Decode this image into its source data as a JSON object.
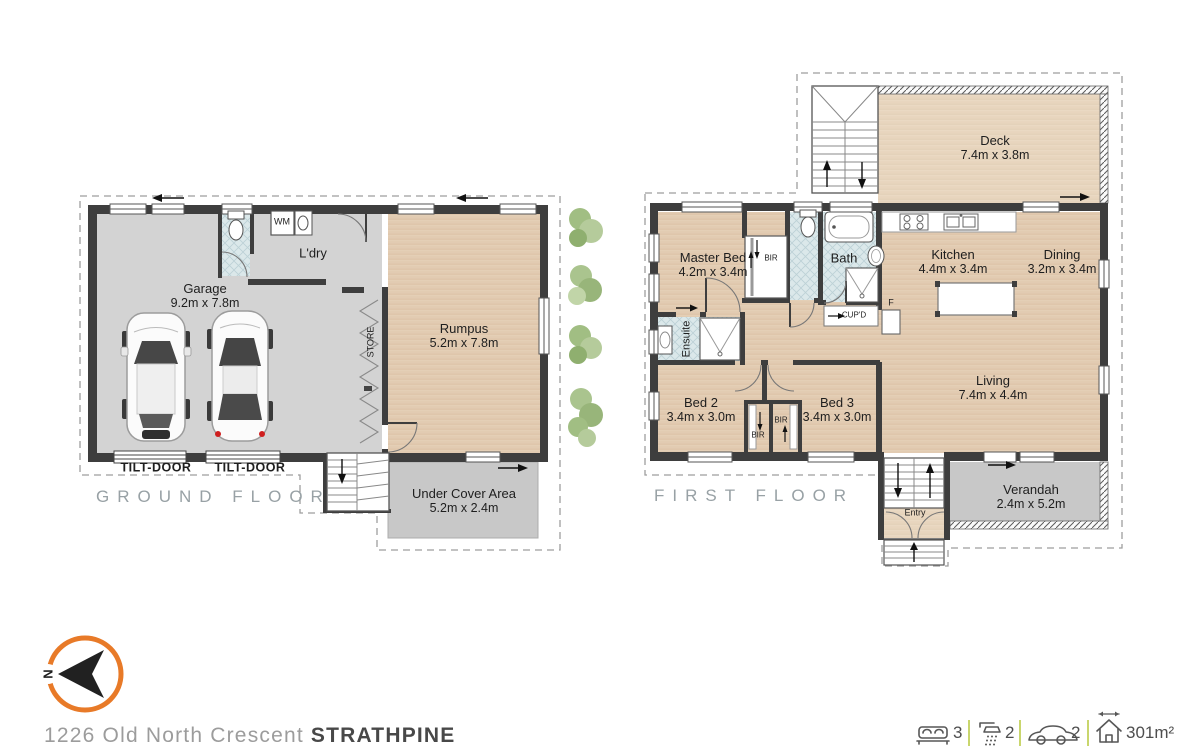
{
  "address": {
    "street": "1226 Old North Crescent",
    "suburb": "STRATHPINE"
  },
  "ground_floor": {
    "label": "GROUND FLOOR",
    "garage": {
      "name": "Garage",
      "dims": "9.2m x 7.8m"
    },
    "ldry": {
      "name": "L'dry"
    },
    "wm": {
      "name": "WM"
    },
    "store": {
      "name": "STORE"
    },
    "rumpus": {
      "name": "Rumpus",
      "dims": "5.2m x 7.8m"
    },
    "under_cover": {
      "name": "Under Cover Area",
      "dims": "5.2m x 2.4m"
    },
    "tilt_door_left": {
      "name": "TILT-DOOR"
    },
    "tilt_door_right": {
      "name": "TILT-DOOR"
    }
  },
  "first_floor": {
    "label": "FIRST FLOOR",
    "deck": {
      "name": "Deck",
      "dims": "7.4m x 3.8m"
    },
    "master_bed": {
      "name": "Master Bed",
      "dims": "4.2m x 3.4m"
    },
    "bir_master": {
      "name": "BIR"
    },
    "bath": {
      "name": "Bath"
    },
    "cupd": {
      "name": "CUP'D"
    },
    "fridge": {
      "name": "F"
    },
    "kitchen": {
      "name": "Kitchen",
      "dims": "4.4m x 3.4m"
    },
    "dining": {
      "name": "Dining",
      "dims": "3.2m x 3.4m"
    },
    "ensuite": {
      "name": "Ensuite"
    },
    "bed2": {
      "name": "Bed 2",
      "dims": "3.4m x 3.0m"
    },
    "bed3": {
      "name": "Bed 3",
      "dims": "3.4m x 3.0m"
    },
    "bir_bed2": {
      "name": "BIR"
    },
    "bir_bed3": {
      "name": "BIR"
    },
    "living": {
      "name": "Living",
      "dims": "7.4m x 4.4m"
    },
    "verandah": {
      "name": "Verandah",
      "dims": "2.4m x 5.2m"
    },
    "entry": {
      "name": "Entry"
    }
  },
  "compass": {
    "north_label": "N"
  },
  "stats": {
    "bedrooms": {
      "icon": "bed-icon",
      "value": "3"
    },
    "bathrooms": {
      "icon": "shower-icon",
      "value": "2"
    },
    "cars": {
      "icon": "car-icon",
      "value": "2"
    },
    "area": {
      "icon": "area-icon",
      "value": "301m²"
    }
  },
  "colors": {
    "wall": "#3e3e3e",
    "indoor_gray": "#d3d3d3",
    "outdoor_gray": "#c8c8c8",
    "wood": "#e4cfb6",
    "deck_wood": "#ead9c3",
    "tile": "#dbe8ea",
    "compass_orange": "#e87a28",
    "divider_green": "#c9d66d",
    "dashed_line": "#9e9e9e",
    "floor_tag_gray": "#98a1a5"
  }
}
